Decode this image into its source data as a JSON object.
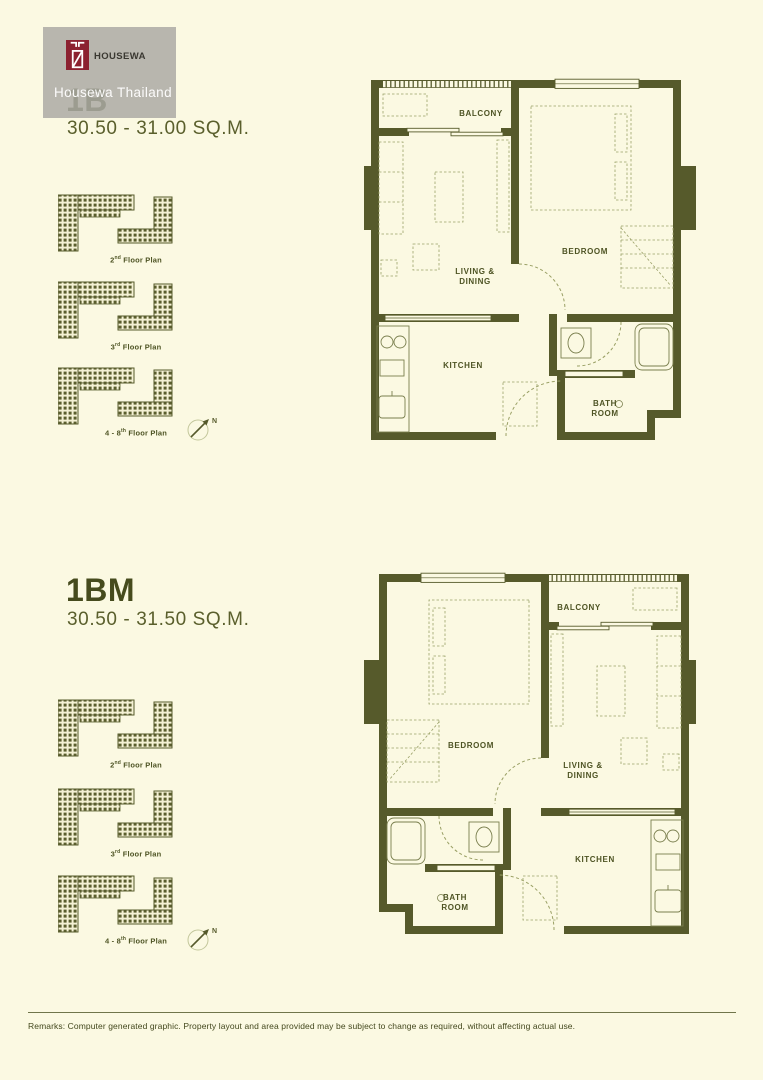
{
  "watermark": {
    "brand": "HOUSEWA",
    "caption": "Housewa Thailand"
  },
  "units": [
    {
      "code": "1B",
      "area_range": "30.50 - 31.00 SQ.M.",
      "rooms": {
        "balcony": "BALCONY",
        "bedroom": "BEDROOM",
        "living_line1": "LIVING &",
        "living_line2": "DINING",
        "kitchen": "KITCHEN",
        "bath_line1": "BATH",
        "bath_line2": "ROOM"
      }
    },
    {
      "code": "1BM",
      "area_range": "30.50 - 31.50 SQ.M.",
      "rooms": {
        "balcony": "BALCONY",
        "bedroom": "BEDROOM",
        "living_line1": "LIVING &",
        "living_line2": "DINING",
        "kitchen": "KITCHEN",
        "bath_line1": "BATH",
        "bath_line2": "ROOM"
      }
    }
  ],
  "key_plans": [
    {
      "prefix": "2",
      "sup": "nd",
      "suffix": " Floor Plan"
    },
    {
      "prefix": "3",
      "sup": "rd",
      "suffix": " Floor Plan"
    },
    {
      "prefix": "4 - 8",
      "sup": "th",
      "suffix": " Floor Plan"
    }
  ],
  "compass": {
    "north": "N"
  },
  "footer": {
    "remarks": "Remarks: Computer generated graphic. Property layout and area provided may be subject to change as required, without affecting actual use."
  },
  "colors": {
    "background": "#FBF9E2",
    "ink": "#565A2B",
    "logo_red": "#8C2130",
    "watermark_gray": "#ACAAA4"
  }
}
